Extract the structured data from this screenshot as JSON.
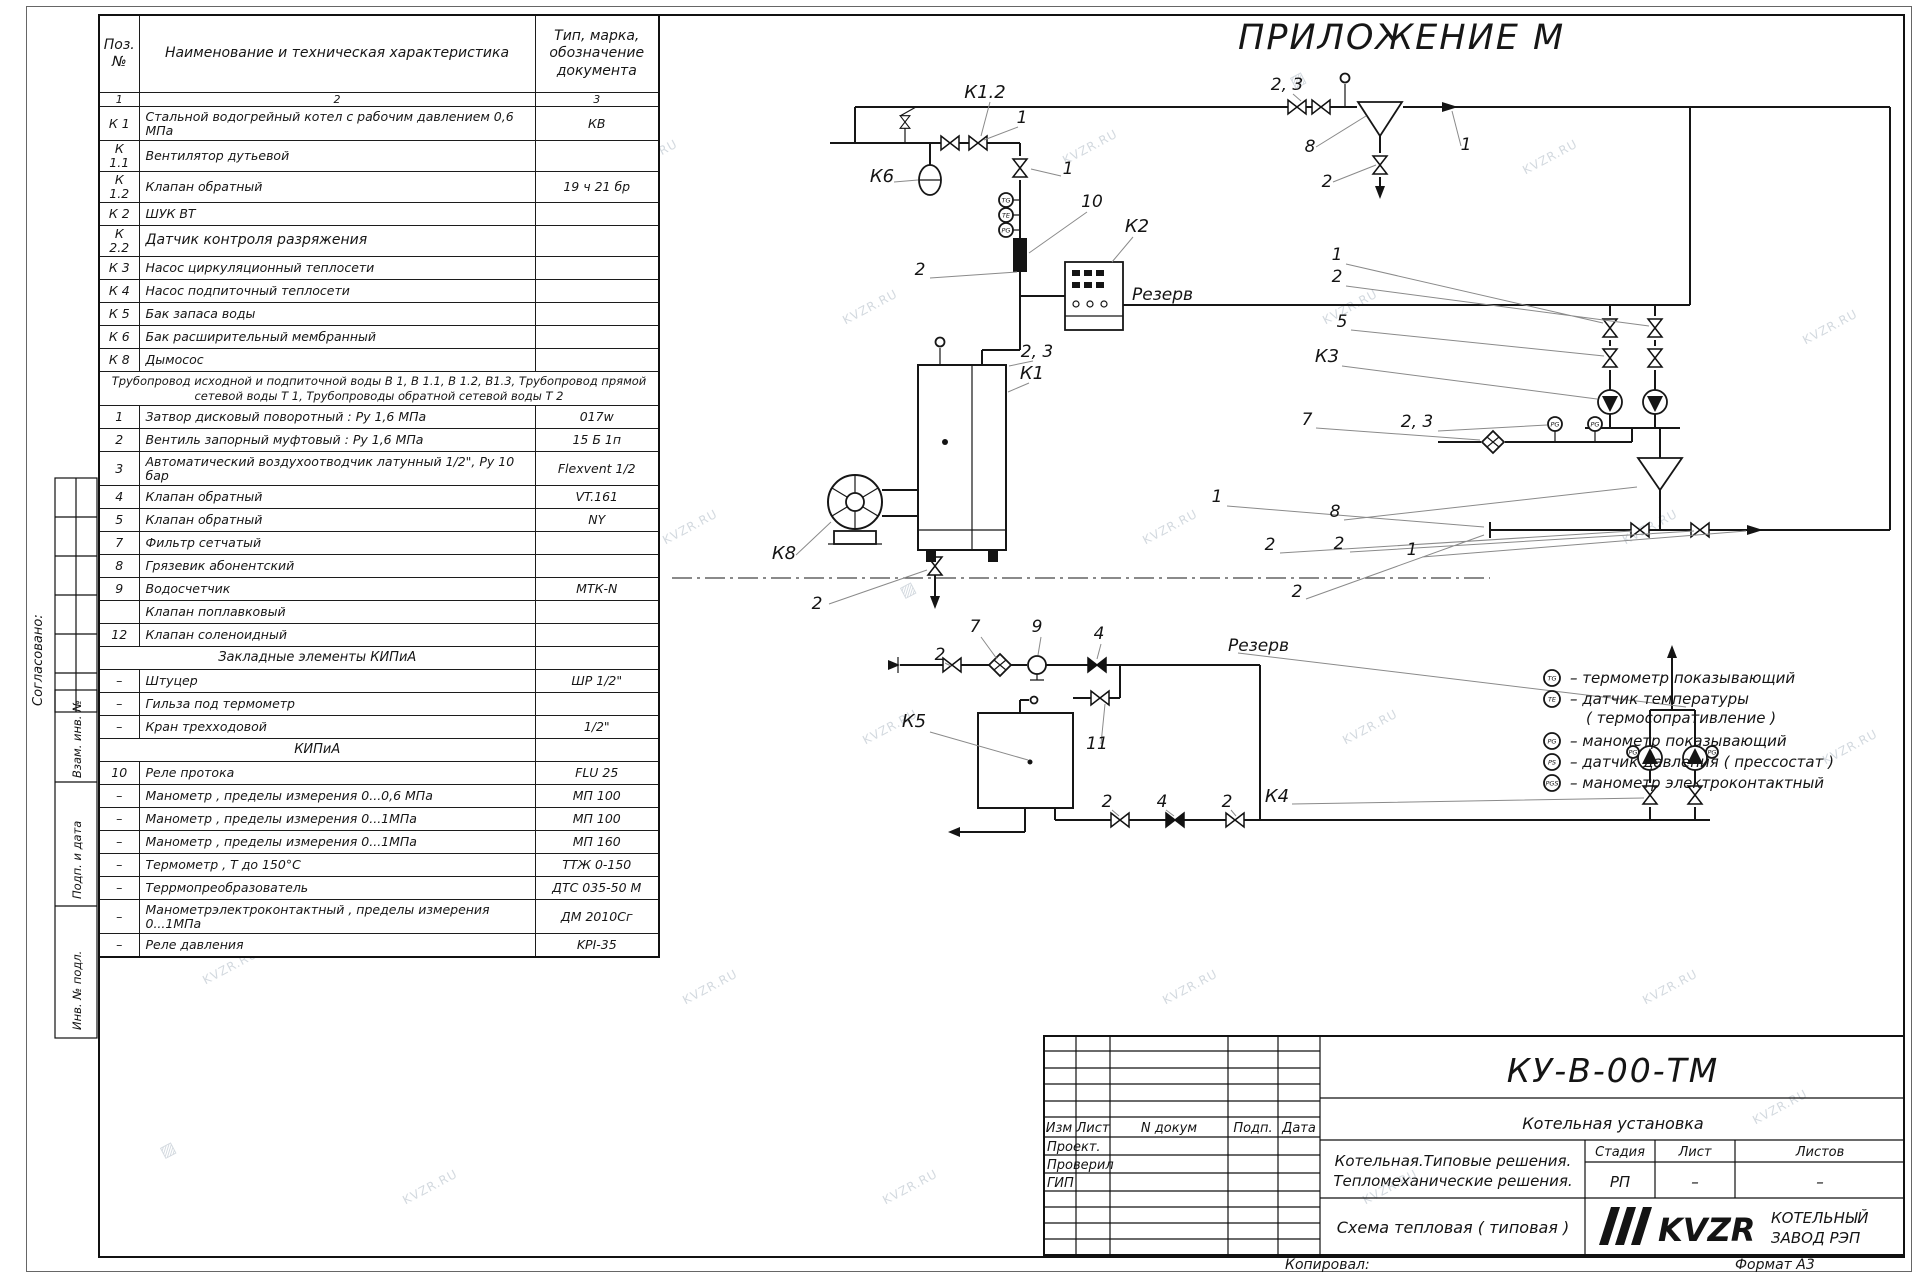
{
  "sheet": {
    "appendix": "ПРИЛОЖЕНИЕ М",
    "copied": "Копировал:",
    "format": "Формат А3",
    "wm": "KVZR.RU",
    "wm_glyph": "▨"
  },
  "side": {
    "agreed": "Согласовано:",
    "vzam": "Взам. инв. №",
    "podp": "Подп. и дата",
    "inv": "Инв. № подл."
  },
  "pt": {
    "headers": {
      "pos": "Поз.\n№",
      "name": "Наименование и техническая характеристика",
      "type": "Тип, марка,\nобозначение\nдокумента"
    },
    "col_numbers": [
      "1",
      "2",
      "3"
    ],
    "rows": [
      {
        "pos": "К 1",
        "name": "Стальной водогрейный котел с рабочим давлением 0,6  МПа",
        "type": "КВ"
      },
      {
        "pos": "К 1.1",
        "name": "Вентилятор дутьевой",
        "type": ""
      },
      {
        "pos": "К 1.2",
        "name": "Клапан обратный",
        "type": "19 ч 21 бр"
      },
      {
        "pos": "К 2",
        "name": "ШУК ВТ",
        "type": ""
      },
      {
        "pos": "К 2.2",
        "name": "Датчик контроля разряжения",
        "type": ""
      },
      {
        "pos": "К 3",
        "name": "Насос циркуляционный теплосети",
        "type": ""
      },
      {
        "pos": "К 4",
        "name": "Насос подпиточный теплосети",
        "type": ""
      },
      {
        "pos": "К 5",
        "name": "Бак запаса воды",
        "type": ""
      },
      {
        "pos": "К 6",
        "name": "Бак расширительный мембранный",
        "type": ""
      },
      {
        "pos": "К 8",
        "name": "Дымосос",
        "type": ""
      },
      {
        "pos": "",
        "name": "Трубопровод исходной и подпиточной воды В 1,   В 1.1,   В 1.2, В1.3,  Трубопровод прямой сетевой воды Т 1,  Трубопроводы обратной сетевой воды Т 2",
        "type": ""
      },
      {
        "pos": "1",
        "name": "Затвор дисковый поворотный :  Ру 1,6  МПа",
        "type": "017w"
      },
      {
        "pos": "2",
        "name": "Вентиль запорный муфтовый :  Ру 1,6  МПа",
        "type": "15 Б 1п"
      },
      {
        "pos": "3",
        "name": "Автоматический воздухоотводчик  латунный 1/2\",  Ру 10 бар",
        "type": "Flexvent 1/2"
      },
      {
        "pos": "4",
        "name": "Клапан обратный",
        "type": "VT.161"
      },
      {
        "pos": "5",
        "name": "Клапан обратный",
        "type": "NY"
      },
      {
        "pos": "7",
        "name": "Фильтр сетчатый",
        "type": ""
      },
      {
        "pos": "8",
        "name": "Грязевик абонентский",
        "type": ""
      },
      {
        "pos": "9",
        "name": "Водосчетчик",
        "type": "МТК-N"
      },
      {
        "pos": "11",
        "name": "Клапан поплавковый",
        "type": ""
      },
      {
        "pos": "12",
        "name": "Клапан соленоидный",
        "type": ""
      },
      {
        "pos": "",
        "name": "Закладные элементы КИПиА",
        "type": ""
      },
      {
        "pos": "–",
        "name": "Штуцер",
        "type": "ШР  1/2\""
      },
      {
        "pos": "–",
        "name": "Гильза под термометр",
        "type": ""
      },
      {
        "pos": "–",
        "name": "Кран трехходовой",
        "type": "1/2\""
      },
      {
        "pos": "",
        "name": "КИПиА",
        "type": ""
      },
      {
        "pos": "10",
        "name": "Реле протока",
        "type": "FLU 25"
      },
      {
        "pos": "–",
        "name": "Манометр , пределы измерения  0...0,6 МПа",
        "type": "МП 100"
      },
      {
        "pos": "–",
        "name": "Манометр , пределы измерения  0...1МПа",
        "type": "МП 100"
      },
      {
        "pos": "–",
        "name": "Манометр , пределы измерения  0...1МПа",
        "type": "МП 160"
      },
      {
        "pos": "–",
        "name": "Термометр , Т  до  150°С",
        "type": "ТТЖ  0-150"
      },
      {
        "pos": "–",
        "name": "Террмопреобразователь",
        "type": "ДТС 035-50 М"
      },
      {
        "pos": "–",
        "name": "Манометрэлектроконтактный ,  пределы измерения 0...1МПа",
        "type": "ДМ 2010Сг"
      },
      {
        "pos": "–",
        "name": "Реле давления",
        "type": "KPI-35"
      }
    ]
  },
  "diagram": {
    "labels": [
      "К1.2",
      "1",
      "2, 3",
      "8",
      "1",
      "2",
      "К6",
      "1",
      "10",
      "К2",
      "Резерв",
      "2",
      "1",
      "2",
      "5",
      "К3",
      "2, 3",
      "К1",
      "7",
      "2, 3",
      "1",
      "8",
      "2",
      "2",
      "1",
      "К8",
      "2",
      "2",
      "7",
      "9",
      "4",
      "2",
      "Резерв",
      "К5",
      "11",
      "2",
      "4",
      "2",
      "К4"
    ],
    "sym": {
      "tg": "TG",
      "te": "TE",
      "pg": "PG",
      "ps": "PS",
      "pgs": "PGS"
    }
  },
  "legend": {
    "items": [
      {
        "sym": "TG",
        "text": "–  термометр показывающий"
      },
      {
        "sym": "TE",
        "text": "–  датчик температуры"
      },
      {
        "sym": "",
        "text": "( термосопративление )"
      },
      {
        "sym": "PG",
        "text": "–  манометр показывающий"
      },
      {
        "sym": "PS",
        "text": "–  датчик давления ( прессостат )"
      },
      {
        "sym": "PGS",
        "text": "–  манометр электроконтактный"
      }
    ]
  },
  "tb": {
    "doc_number": "КУ-В-00-ТМ",
    "unit_name": "Котельная установка",
    "name1": "Котельная.Типовые решения.",
    "name2": "Тепломеханические решения.",
    "drawing": "Схема тепловая ( типовая )",
    "stage_h": "Стадия",
    "list_h": "Лист",
    "listov_h": "Листов",
    "stage": "РП",
    "list": "–",
    "listov": "–",
    "izm": "Изм",
    "list_col": "Лист",
    "ndoc": "N докум",
    "podp": "Подп.",
    "date": "Дата",
    "r1": "Проект.",
    "r2": "Проверил",
    "r3": "ГИП",
    "logo": "KVZR",
    "comp1": "КОТЕЛЬНЫЙ",
    "comp2": "ЗАВОД РЭП"
  }
}
